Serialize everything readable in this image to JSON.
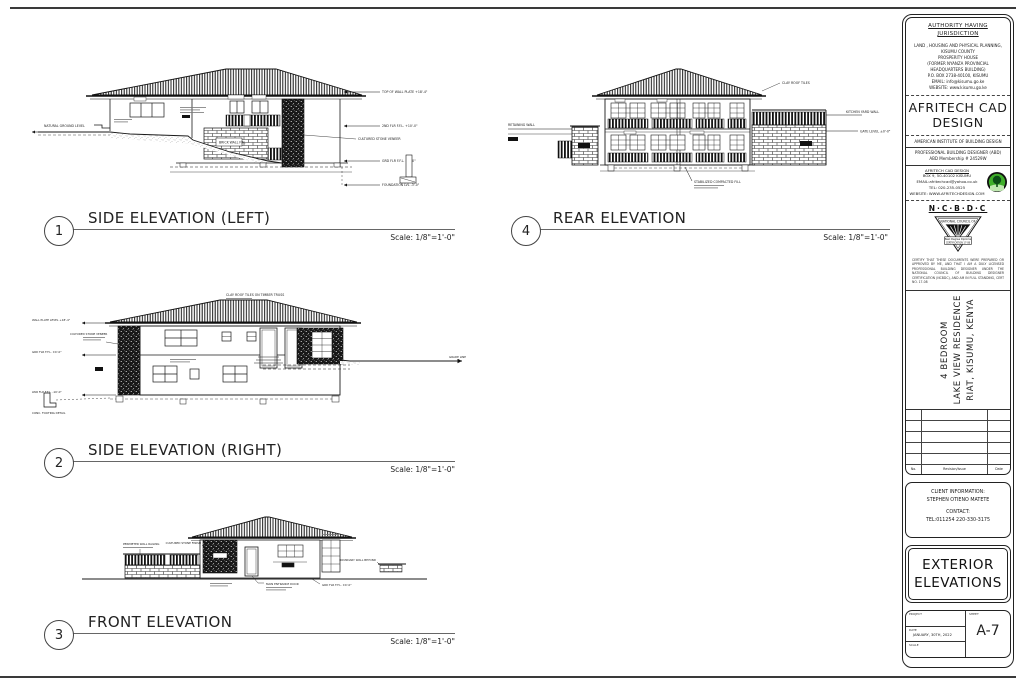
{
  "drawings": [
    {
      "number": "1",
      "title": "SIDE ELEVATION (LEFT)",
      "scale": "Scale: 1/8\"=1'-0\""
    },
    {
      "number": "4",
      "title": "REAR ELEVATION",
      "scale": "Scale: 1/8\"=1'-0\""
    },
    {
      "number": "2",
      "title": "SIDE ELEVATION (RIGHT)",
      "scale": "Scale: 1/8\"=1'-0\""
    },
    {
      "number": "3",
      "title": "FRONT ELEVATION",
      "scale": "Scale: 1/8\"=1'-0\""
    }
  ],
  "annotations": {
    "d1": {
      "ground": "NATURAL GROUND LEVEL",
      "lvl_top": "TOP OF WALL PLATE +18'-4\"",
      "lvl_2nd": "2ND FLR F.F.L. +10'-0\"",
      "lvl_grd": "GRD FLR F.F.L. ±0'-0\"",
      "lvl_fnd": "FOUNDATION LVL -3'-0\"",
      "stone": "CULTURED STONE VENEER",
      "brick": "BRICK WALL FIN."
    },
    "d4": {
      "left": "RETAINING WALL",
      "roof": "CLAY ROOF TILES",
      "right1": "KITCHEN YARD WALL",
      "right2": "GATE LEVEL ±0'-0\"",
      "bottom": "STABILIZED COMPACTED FILL"
    },
    "d2": {
      "roof": "CLAY ROOF TILES ON TIMBER TRUSS",
      "lvl_top": "WALL PLATE LEVEL +18'-4\"",
      "stone": "CULTURED STONE VENEER",
      "lvl_grd": "GRD FLR F.F.L. ±0'-0\"",
      "lvl_low": "LWR FLR F.F.L. -10'-0\"",
      "footing": "CONC. FOOTING DETAIL",
      "grade": "GRADE LINE"
    },
    "d3": {
      "fence": "PERIMETER WALL RAILING",
      "stone": "CULTURED STONE FINISH",
      "door": "MAIN ENTRANCE DOOR",
      "wall": "BOUNDARY WALL BEYOND",
      "level": "GRD FLR F.F.L. ±0'-0\""
    }
  },
  "titleblock": {
    "authority": {
      "heading": "AUTHORITY HAVING JURISDICTION",
      "lines": [
        "LAND , HOUSING AND PHYSICAL PLANNING,",
        "KISUMU COUNTY",
        "PROSPERITY HOUSE",
        "(FORMER NYANZA PROVINCIAL",
        "HEADQUARTERS BUILDING)",
        "P.O. BOX 2738-40100, KISUMU",
        "EMAIL:  info@kisumu.go.ke",
        "WEBSITE: www.kisumu.go.ke"
      ]
    },
    "firm": {
      "name": "AFRITECH CAD DESIGN",
      "institute": "AMERICAN INSTITUTE OF BUILDING DESIGN",
      "designer_line1": "PROFESSIONAL BUILDING DESIGNER (ABD)",
      "designer_line2": "ABD Membership # 24529W",
      "contact_lines": [
        "AFRITECH CAD DESIGN",
        "BOX 9, 50-40102 KISUMU",
        "EMAIL:afritechcad@yahoo.co.uk",
        "TEL: 020-235-0525",
        "WEBSITE: WWW.AFRITECHDESIGN.COM"
      ]
    },
    "ncbdc": {
      "name": "N·C·B·D·C",
      "arc": "NATIONAL COUNCIL OF",
      "badge_line1": "Best Degree Diploma",
      "badge_line2": "CERTIFICATION 17-08",
      "disclaimer": "CERTIFY THAT THESE DOCUMENTS WERE PREPARED OR APPROVED BY ME, AND THAT I AM A DULY LICENSED PROFESSIONAL BUILDING DESIGNER UNDER THE NATIONAL COUNCIL OF BUILDING DESIGNER CERTIFICATION (NCBDC), AND AM IN FULL STANDING, CERT NO. 17-08"
    },
    "project": {
      "line1": "4 BEDROOM",
      "line2": "LAKE VIEW RESIDENCE",
      "line3": "RIAT, KISUMU, KENYA"
    },
    "revisions": {
      "col_no": "No.",
      "col_rev": "Revision/Issue",
      "col_date": "Date"
    },
    "client": {
      "heading": "CLIENT INFORMATION:",
      "name": "STEPHEN OTIENO MATETE",
      "contact_heading": "CONTACT:",
      "phone": "TEL:011254 220-330-3175"
    },
    "sheet_title": "EXTERIOR ELEVATIONS",
    "meta": {
      "project_label": "PROJECT",
      "date_label": "DATE",
      "date_value": "JANUARY, 30TH, 2022",
      "scale_label": "SCALE",
      "sheet_label": "SHEET",
      "sheet_number": "A-7"
    }
  }
}
